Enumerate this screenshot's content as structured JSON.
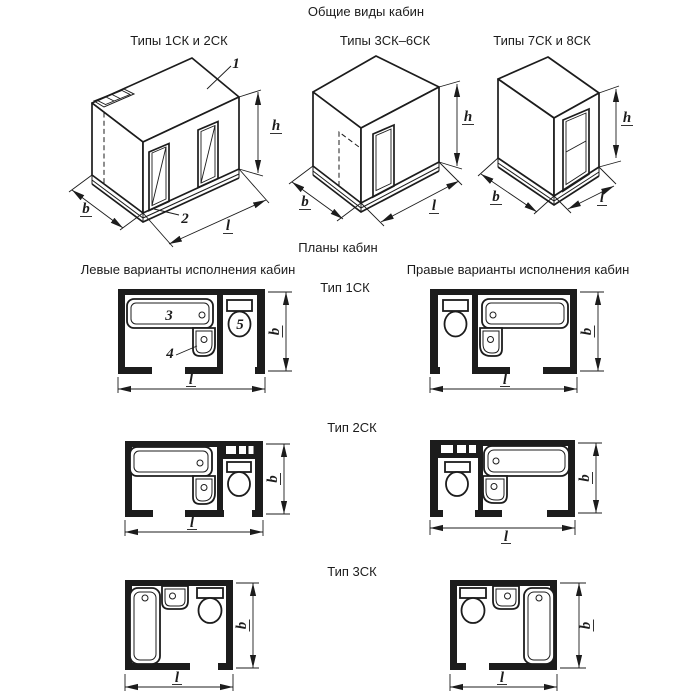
{
  "document": {
    "title": "Общие виды кабин",
    "plans_title": "Планы кабин"
  },
  "general_views": [
    {
      "title": "Типы 1СК и 2СК"
    },
    {
      "title": "Типы 3СК–6СК"
    },
    {
      "title": "Типы 7СК и 8СК"
    }
  ],
  "plan_columns": {
    "left": "Левые варианты исполнения кабин",
    "right": "Правые варианты исполнения кабин"
  },
  "plan_rows": [
    {
      "label": "Тип 1СК"
    },
    {
      "label": "Тип 2СК"
    },
    {
      "label": "Тип 3СК"
    }
  ],
  "dimensions": {
    "width": "b",
    "length": "l",
    "height": "h"
  },
  "callouts": {
    "ceiling_panel": "1",
    "floor_panel": "2",
    "bathtub": "3",
    "washbasin": "4",
    "toilet": "5"
  },
  "colors": {
    "ink": "#1c1c1c",
    "paper": "#ffffff"
  }
}
